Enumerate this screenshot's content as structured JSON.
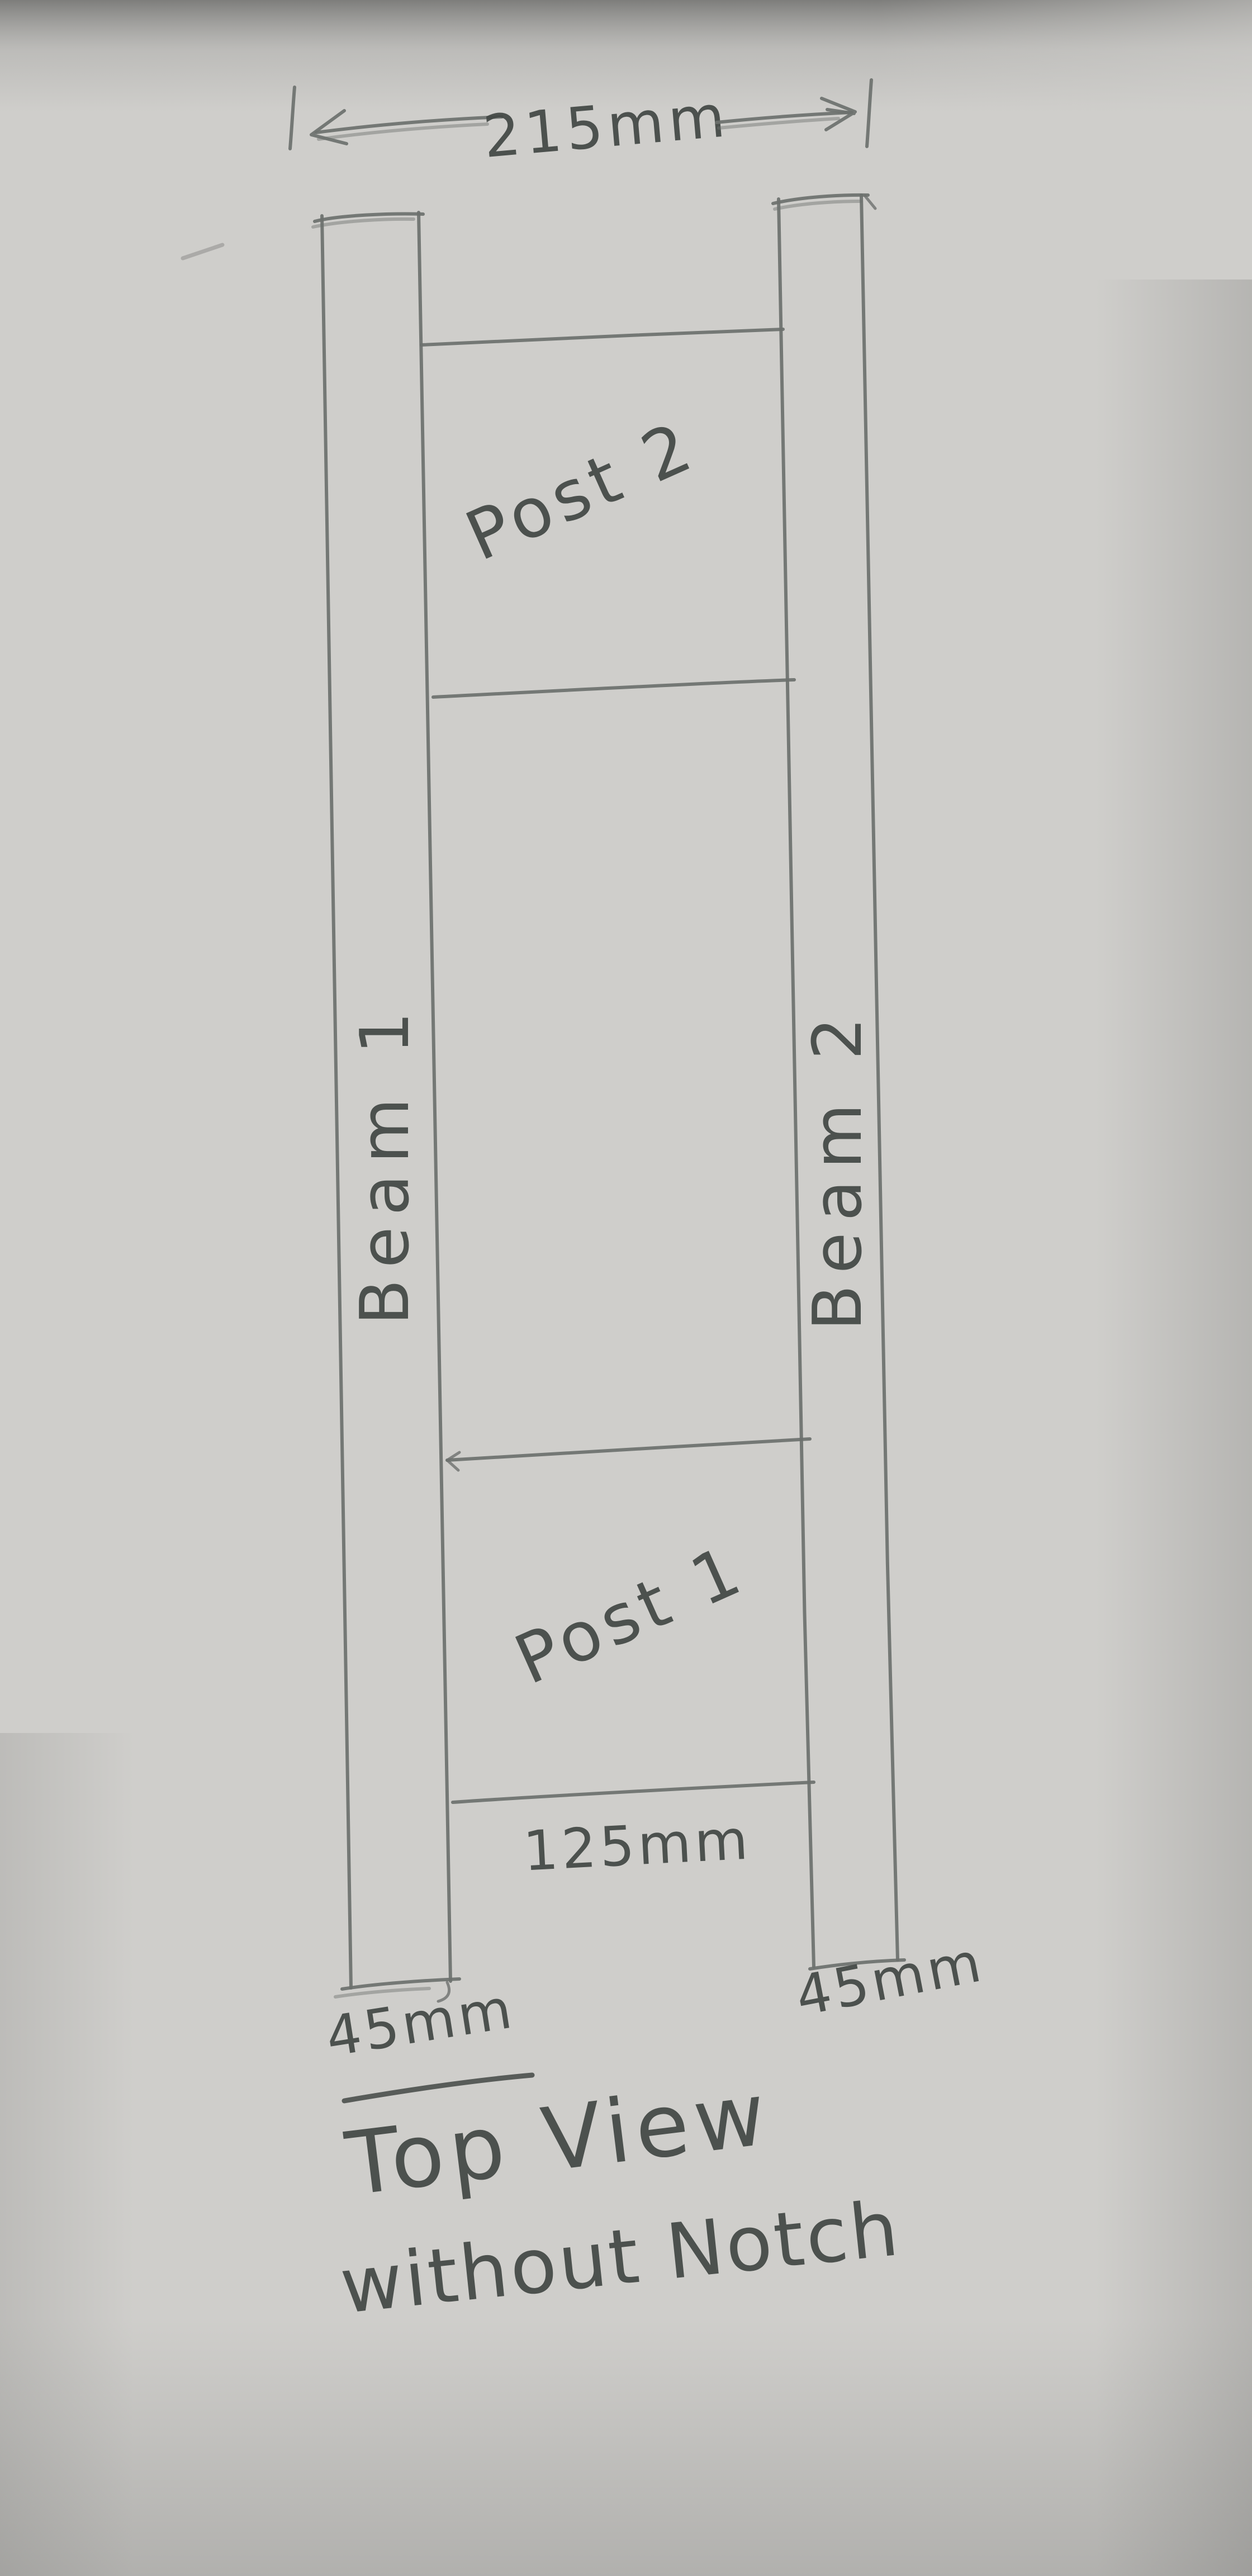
{
  "labels": {
    "overall_width": "215mm",
    "beam1": "Beam 1",
    "beam2": "Beam 2",
    "post1": "Post 1",
    "post2": "Post 2",
    "post1_width": "125mm",
    "beam1_width": "45mm",
    "beam2_width": "45mm",
    "title_line1": "Top View",
    "title_line2": "without Notch"
  },
  "colors": {
    "paper": "#cfcecb",
    "pencil": "#6d716e",
    "ink": "#434845",
    "shade": "#7d7d7b"
  },
  "diagram": {
    "type": "hand-drawn-technical-sketch",
    "view": "Top View without Notch",
    "overall_width_mm": 215,
    "beam_width_mm": 45,
    "post1_width_mm": 125,
    "parts": [
      "Beam 1",
      "Beam 2",
      "Post 1",
      "Post 2"
    ]
  }
}
